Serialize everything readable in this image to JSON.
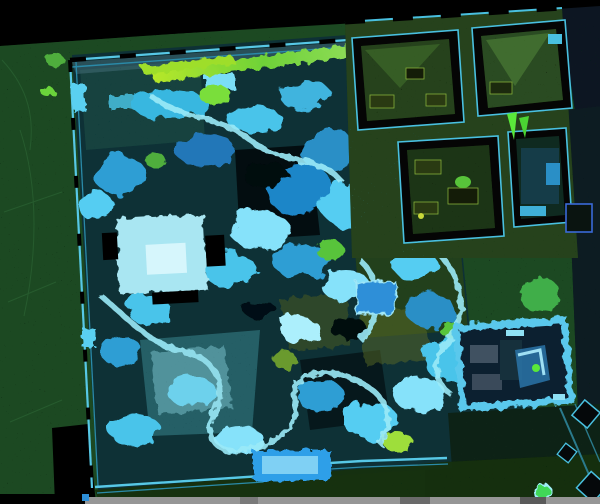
{
  "scene": {
    "view": "orthographic-top-down",
    "render_style": "elevation-colored lidar point cloud on black",
    "subject": "walled garden with rockery, ponds, pavilions and an adjoining building complex"
  },
  "palette": {
    "background": "#000000",
    "exterior_grounds": "#1e4a24",
    "exterior_dark_navy": "#081820",
    "exterior_courtyard": "#0c2418",
    "garden_base": "#0e3136",
    "garden_wash": "#3d8c96",
    "walkway_band": "#4e7484",
    "wall_cyan": "#57c8e6",
    "wall_gate_bright": "#5ad0f0",
    "rock_blue_deep": "#1f86c8",
    "rock_cyan": "#49c4ea",
    "rock_cyan_pale": "#86e2fa",
    "path_bright": "#9beaf8",
    "pavilion_pale": "#a9e6f2",
    "pavilion_core": "#d6f6fc",
    "pond_pale": "#8fd8e4",
    "boat_pavilion_blue": "#2d9fe8",
    "box_blue": "#2d8fd8",
    "ridge_lime": "#9ede2a",
    "ridge_green": "#3fae3c",
    "foliage_green": "#3fae4a",
    "foliage_bright": "#5ae83a",
    "building_floor": "#25421c",
    "building_wedge": "#3d6a2a",
    "room_wall_black": "#050505",
    "furniture_olive": "#2a3a12",
    "bright_room_wall": "#5ac8ec",
    "bright_room_interior": "#0c2030",
    "annex_outline_blue": "#3a6ad8",
    "tree_green": "#3fd858",
    "ground_strip_gray": "#969696",
    "contour_line_green": "#2f6a38"
  },
  "features": {
    "exterior": "speckled street / grounds around the walls",
    "north_ridge": "bright lime roof ridge along north wall",
    "pavilion_roof": "pale square pavilion roof, west-center",
    "rockery": "irregular cyan-blue rockery and shrubs filling the garden",
    "pond": "translucent pale pond surface, south-west",
    "boat_pavilion": "bright blue rectangular pavilion on south edge",
    "building_complex": "north-east rooms with black walls and olive floors",
    "green_triangle_markers": "two bright green triangular roof facets",
    "southeast_room": "thick bright-cyan walled room with furniture",
    "courtyard_tree": "round bright green tree canopy, south-east",
    "planter_squares": "dark diagonal planter squares along east path",
    "ground_strip": "gray pavement strip along bottom edge"
  }
}
